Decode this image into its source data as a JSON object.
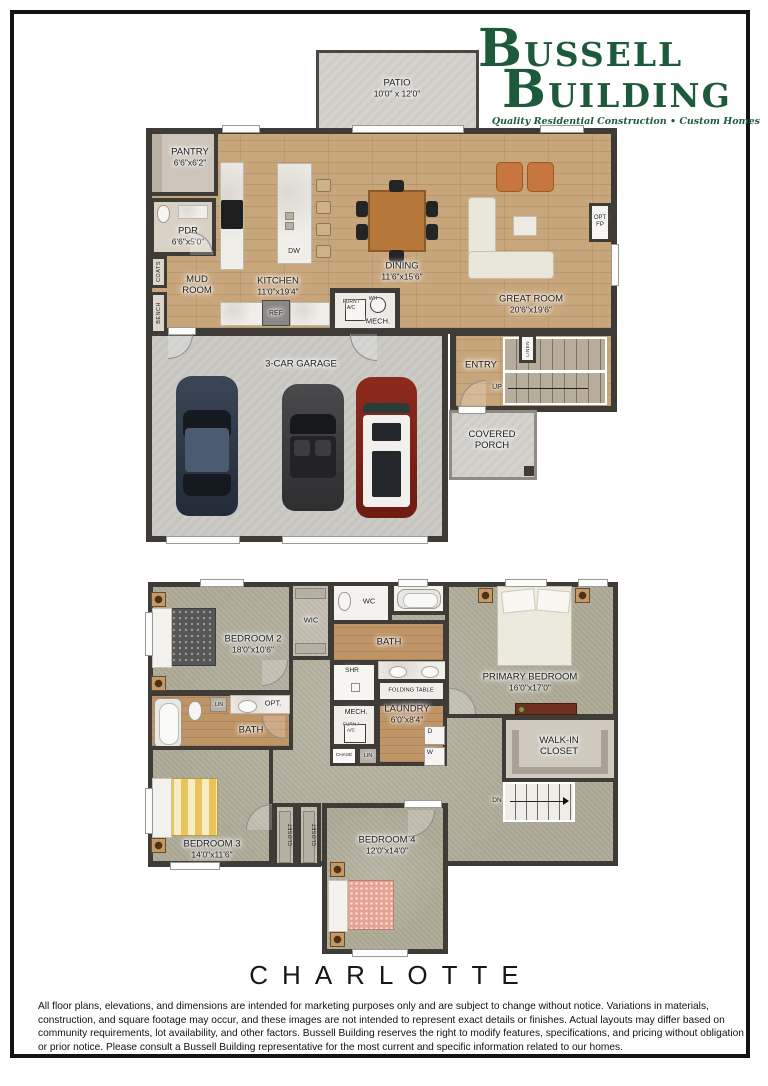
{
  "palette": {
    "logo_green": "#1d5a3c",
    "wall": "#3f3b36",
    "wood_floor": "#c8a67c",
    "bath_wood": "#bf9466",
    "carpet": "#b2ae9b",
    "concrete": "#cccbc6"
  },
  "logo": {
    "line1_initial": "B",
    "line1_rest": "USSELL",
    "line2_initial": "B",
    "line2_rest": "UILDING",
    "tagline": "Quality Residential Construction • Custom Homes"
  },
  "floor1": {
    "patio_name": "PATIO",
    "patio_dims": "10'0\" x 12'0\"",
    "pantry_name": "PANTRY",
    "pantry_dims": "6'6\"x6'2\"",
    "pdr_name": "PDR",
    "pdr_dims": "6'6\"x5'0\"",
    "coats": "COATS",
    "bench": "BENCH",
    "mud_line1": "MUD",
    "mud_line2": "ROOM",
    "kitchen_name": "KITCHEN",
    "kitchen_dims": "11'0\"x19'4\"",
    "dw": "DW",
    "ref": "REF",
    "dining_name": "DINING",
    "dining_dims": "11'6\"x15'6\"",
    "great_name": "GREAT ROOM",
    "great_dims": "20'6\"x19'6\"",
    "opt_line1": "OPT",
    "opt_line2": "FP",
    "furn_line1": "FURN /",
    "furn_line2": "A/C",
    "wh": "WH",
    "mech": "MECH.",
    "garage": "3-CAR GARAGE",
    "entry": "ENTRY",
    "up": "UP",
    "linen": "LINEN",
    "porch_line1": "COVERED",
    "porch_line2": "PORCH"
  },
  "floor2": {
    "bedroom2_name": "BEDROOM 2",
    "bedroom2_dims": "18'0\"x10'6\"",
    "wic": "WIC",
    "wc": "WC",
    "bath_top": "BATH",
    "shr": "SHR",
    "folding_table": "FOLDING TABLE",
    "primary_name": "PRIMARY BEDROOM",
    "primary_dims": "16'0\"x17'0\"",
    "mech": "MECH.",
    "furn_line1": "FURN /",
    "furn_line2": "A/C",
    "laundry_name": "LAUNDRY",
    "laundry_dims": "6'0\"x8'4\"",
    "dryer": "D",
    "washer": "W",
    "chase": "CHASE",
    "lin_hall": "LIN",
    "lin_bath": "LIN",
    "opt": "OPT.",
    "bath_left": "BATH",
    "walkin_line1": "WALK-IN",
    "walkin_line2": "CLOSET",
    "dn": "DN",
    "bedroom3_name": "BEDROOM 3",
    "bedroom3_dims": "14'0\"x11'6\"",
    "closet_a": "CLOSET",
    "closet_b": "CLOSET",
    "bedroom4_name": "BEDROOM 4",
    "bedroom4_dims": "12'0\"x14'0\""
  },
  "title": "CHARLOTTE",
  "disclaimer": "All floor plans, elevations, and dimensions are intended for marketing purposes only and are subject to change without notice. Variations in materials, construction, and square footage may occur, and these images are not intended to represent exact details or finishes. Actual layouts may differ based on community requirements, lot availability, and other factors. Bussell Building reserves the right to modify features, specifications, and pricing without obligation or prior notice. Please consult a Bussell Building representative for the most current and specific information related to our homes."
}
